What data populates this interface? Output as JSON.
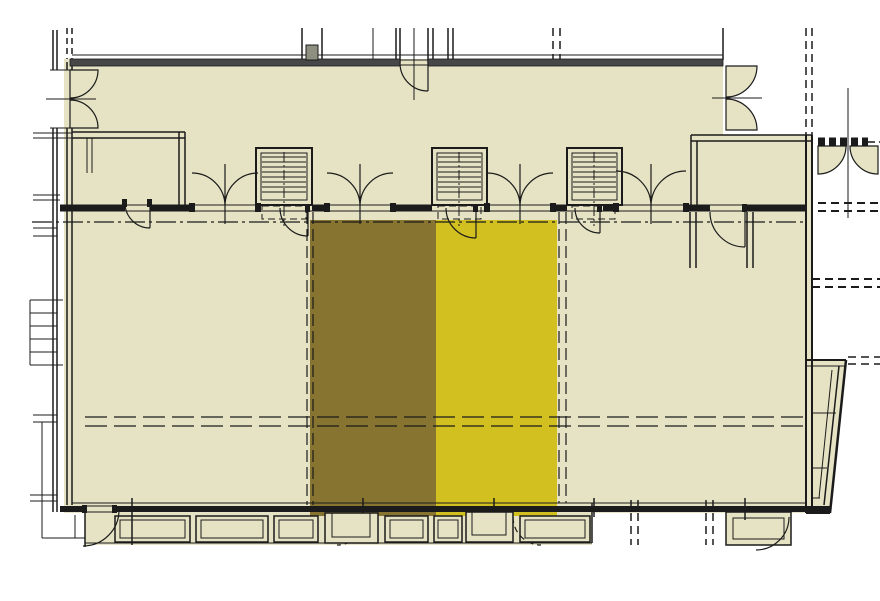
{
  "canvas": {
    "width": 880,
    "height": 601,
    "background": "#ffffff"
  },
  "palette": {
    "floor": "#e5e3c4",
    "wall_line": "#1b1b1b",
    "wall_band": "#474747",
    "chimney_fill": "#8f8f80"
  },
  "regions": {
    "highlight_left": {
      "name": "highlighted-unit-left",
      "color": "#877431"
    },
    "highlight_right": {
      "name": "highlighted-unit-right",
      "color": "#d2bf20"
    }
  }
}
